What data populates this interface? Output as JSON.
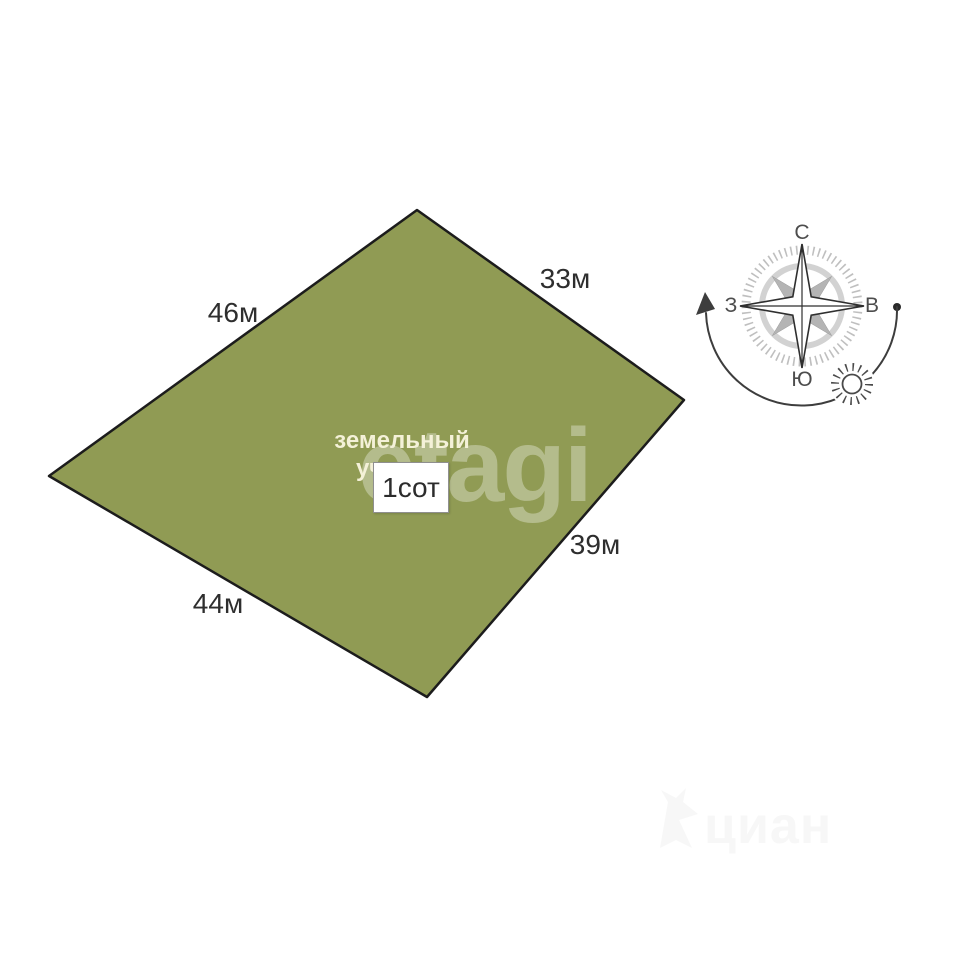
{
  "plot": {
    "name_label": "земельный участок",
    "area_label": "1сот",
    "fill_color": "#909b54",
    "outline_color": "#1c1c1c",
    "sides": {
      "top_left": "46м",
      "top_right": "33м",
      "bottom_right": "39м",
      "bottom_left": "44м"
    }
  },
  "compass": {
    "north": "С",
    "south": "Ю",
    "west": "З",
    "east": "В"
  },
  "watermarks": {
    "center": "etagi",
    "bottom_right": "циан"
  }
}
